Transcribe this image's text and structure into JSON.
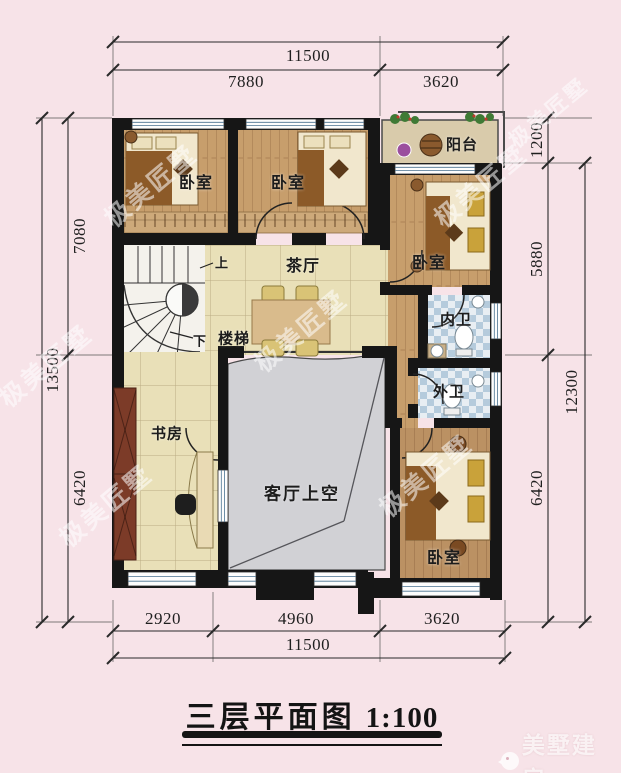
{
  "title": {
    "text": "三层平面图",
    "scale": "1:100"
  },
  "dimensions": {
    "top": {
      "overall": "11500",
      "seg_left": "7880",
      "seg_right": "3620"
    },
    "bottom": {
      "seg_left": "2920",
      "seg_mid": "4960",
      "seg_right": "3620",
      "overall": "11500"
    },
    "left": {
      "overall": "13500",
      "seg_top": "7080",
      "seg_bottom": "6420"
    },
    "right": {
      "seg_top": "1200",
      "seg_mid": "5880",
      "seg_bottom": "6420",
      "overall": "12300"
    }
  },
  "plan": {
    "rooms": [
      {
        "id": "bedroom-top-left",
        "label": "卧室"
      },
      {
        "id": "bedroom-top-middle",
        "label": "卧室"
      },
      {
        "id": "balcony",
        "label": "阳台"
      },
      {
        "id": "bedroom-right",
        "label": "卧室"
      },
      {
        "id": "tea-hall",
        "label": "茶厅"
      },
      {
        "id": "stairs",
        "label": "楼梯"
      },
      {
        "id": "inner-bathroom",
        "label": "内卫"
      },
      {
        "id": "outer-bathroom",
        "label": "外卫"
      },
      {
        "id": "study",
        "label": "书房"
      },
      {
        "id": "living-room-void",
        "label": "客厅上空"
      },
      {
        "id": "bedroom-bottom-right",
        "label": "卧室"
      }
    ],
    "stair_up": "上",
    "stair_down": "下"
  },
  "watermark": {
    "text": "极美匠墅",
    "logo_text": "美墅建房"
  },
  "colors": {
    "background": "#f7e3e8",
    "wall": "#161616",
    "wood_floor": "#c79e6c",
    "tile_floor": "#eae0b8",
    "bath_tile": "#b5cbdc",
    "void_gray": "#d1d1d5"
  }
}
